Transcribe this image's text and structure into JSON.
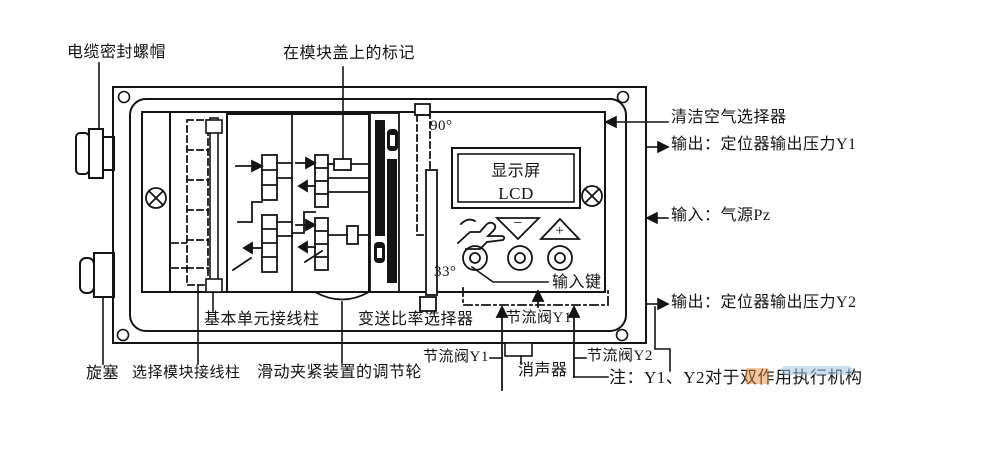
{
  "diagram": {
    "device": {
      "display": {
        "line1": "显示屏",
        "line2": "LCD"
      },
      "angle_top": "90°",
      "angle_bottom": "33°",
      "keypad": {
        "minus": "−",
        "plus": "+"
      },
      "throttle_inner": "节流阀Y1"
    },
    "callouts": {
      "cable_gland": "电缆密封螺帽",
      "module_cover_mark": "在模块盖上的标记",
      "clean_air_selector": "清洁空气选择器",
      "output_y1": "输出：定位器输出压力Y1",
      "input_pz": "输入：气源Pz",
      "output_y2": "输出：定位器输出压力Y2",
      "input_keys": "输入键",
      "base_unit_terminals": "基本单元接线柱",
      "ratio_selector": "变送比率选择器",
      "throttle_y1": "节流阀Y1",
      "throttle_y2": "节流阀Y2",
      "muffler": "消声器",
      "note": "注：Y1、Y2对于双作用执行机构",
      "plug": "旋塞",
      "select_module_terminals": "选择模块接线柱",
      "slide_clamp_wheel": "滑动夹紧装置的调节轮"
    },
    "colors": {
      "line": "#141414",
      "background": "#ffffff",
      "watermark_orange": "#e89040",
      "watermark_blue": "#9fc4e6"
    }
  }
}
